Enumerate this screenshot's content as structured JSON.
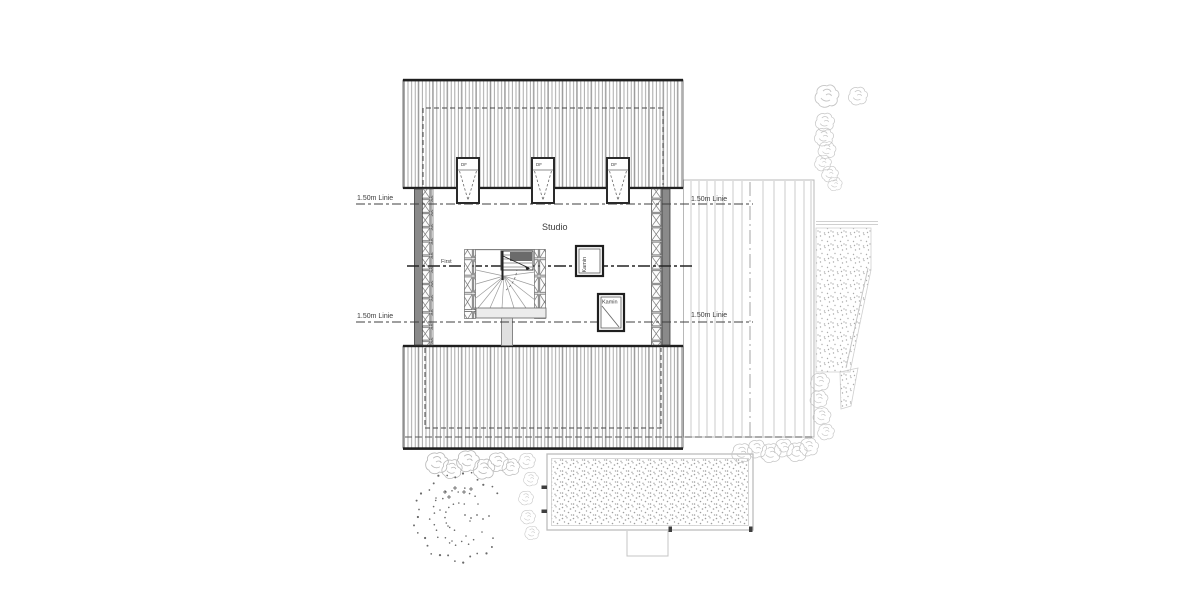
{
  "plan": {
    "room_label": "Studio",
    "ridge_label": "First",
    "chimney_upper_label": "Kamin",
    "chimney_lower_label": "Kamin",
    "skylight_label": "DF",
    "height_lines": {
      "upper_left": "1.50m Linie",
      "upper_right": "1.50m Linie",
      "lower_left": "1.50m Linie",
      "lower_right": "1.50m Linie"
    }
  },
  "colors": {
    "paper": "#ffffff",
    "ink": "#1f1f1f",
    "wall_fill": "#8a8a8a",
    "roof_hatch": "#9a9a9a",
    "decor_gray": "#c5c5c5",
    "text": "#3c3c3c"
  }
}
